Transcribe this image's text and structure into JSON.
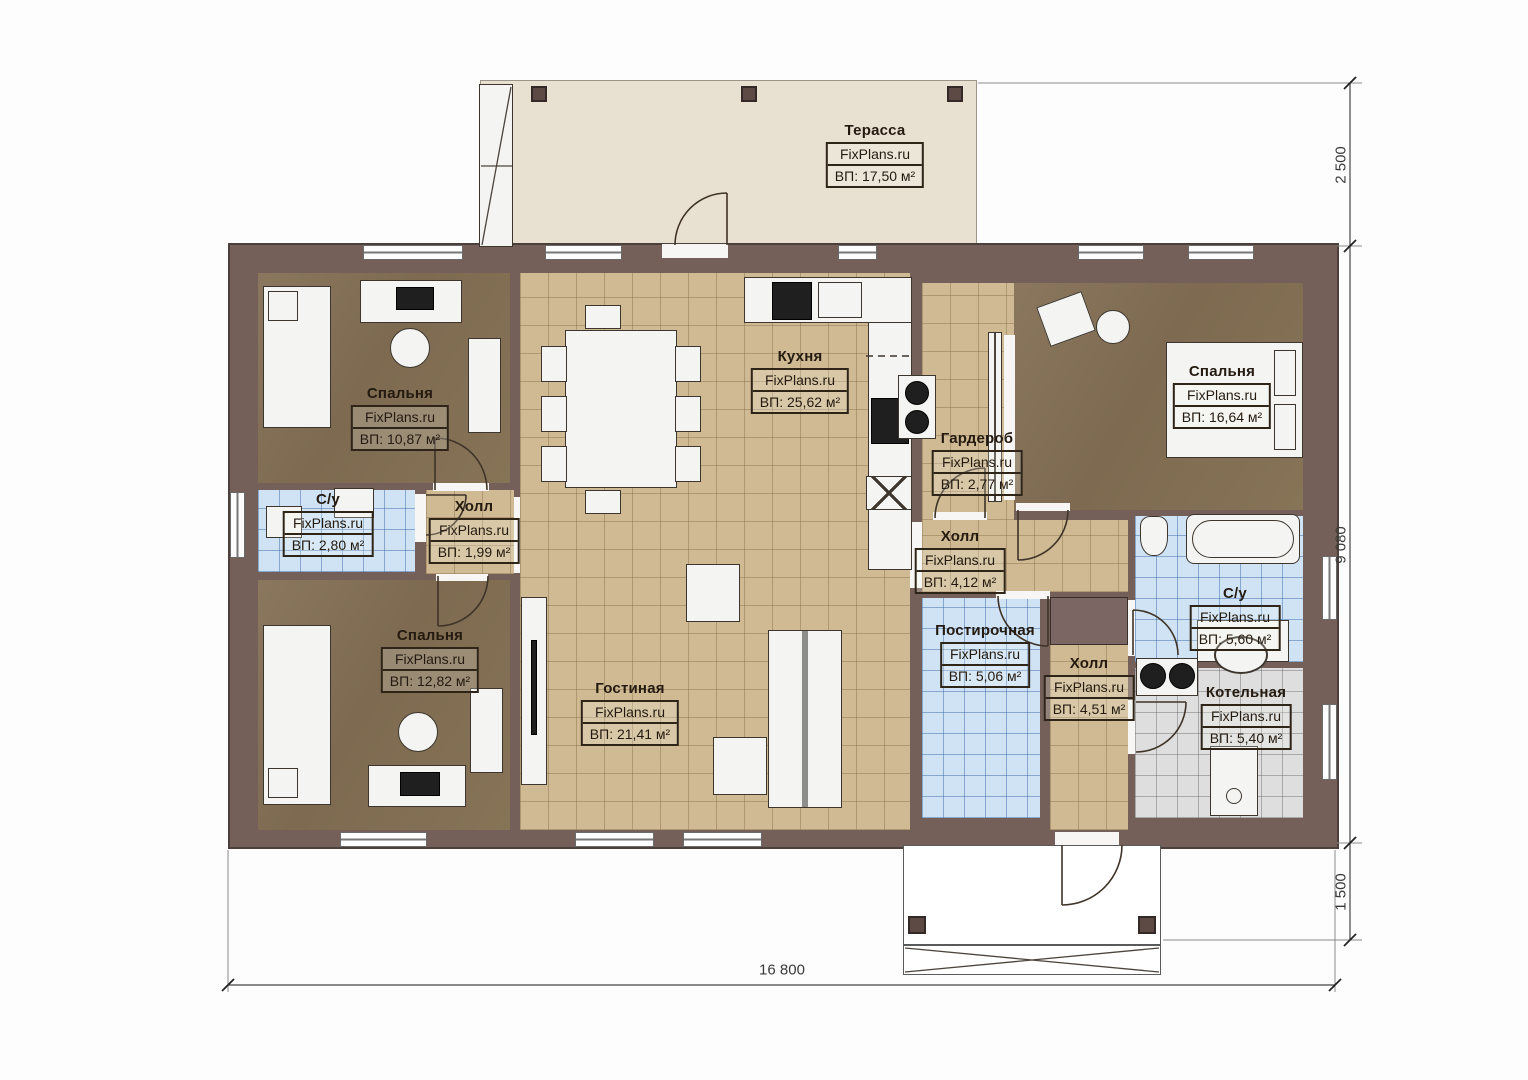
{
  "brand": "FixPlans.ru",
  "rooms": [
    {
      "id": "terrace",
      "name": "Терасса",
      "brand": "FixPlans.ru",
      "area": "ВП: 17,50 м²"
    },
    {
      "id": "bedroom1",
      "name": "Спальня",
      "brand": "FixPlans.ru",
      "area": "ВП: 10,87 м²"
    },
    {
      "id": "kitchen",
      "name": "Кухня",
      "brand": "FixPlans.ru",
      "area": "ВП: 25,62 м²"
    },
    {
      "id": "wardrobe",
      "name": "Гардероб",
      "brand": "FixPlans.ru",
      "area": "ВП: 2,77 м²"
    },
    {
      "id": "bedroom2",
      "name": "Спальня",
      "brand": "FixPlans.ru",
      "area": "ВП: 16,64 м²"
    },
    {
      "id": "bath1",
      "name": "С/у",
      "brand": "FixPlans.ru",
      "area": "ВП: 2,80 м²"
    },
    {
      "id": "hall1",
      "name": "Холл",
      "brand": "FixPlans.ru",
      "area": "ВП: 1,99 м²"
    },
    {
      "id": "hall2",
      "name": "Холл",
      "brand": "FixPlans.ru",
      "area": "ВП: 4,12 м²"
    },
    {
      "id": "bath2",
      "name": "С/у",
      "brand": "FixPlans.ru",
      "area": "ВП: 5,60 м²"
    },
    {
      "id": "bedroom3",
      "name": "Спальня",
      "brand": "FixPlans.ru",
      "area": "ВП: 12,82 м²"
    },
    {
      "id": "living",
      "name": "Гостиная",
      "brand": "FixPlans.ru",
      "area": "ВП: 21,41 м²"
    },
    {
      "id": "laundry",
      "name": "Постирочная",
      "brand": "FixPlans.ru",
      "area": "ВП: 5,06 м²"
    },
    {
      "id": "hall3",
      "name": "Холл",
      "brand": "FixPlans.ru",
      "area": "ВП: 4,51 м²"
    },
    {
      "id": "boiler",
      "name": "Котельная",
      "brand": "FixPlans.ru",
      "area": "ВП: 5,40 м²"
    }
  ],
  "dimensions": {
    "terrace_depth": "2 500",
    "house_depth": "9 080",
    "porch_depth": "1 500",
    "total_width": "16 800"
  },
  "colors": {
    "wall": "#746059",
    "terrace_floor": "#e8e1d1",
    "tile_beige": "#cfba94",
    "tile_blue": "#cfe3f5",
    "tile_gray": "#dedede",
    "floor_brown": "#837050",
    "label_ink": "#241a10"
  }
}
